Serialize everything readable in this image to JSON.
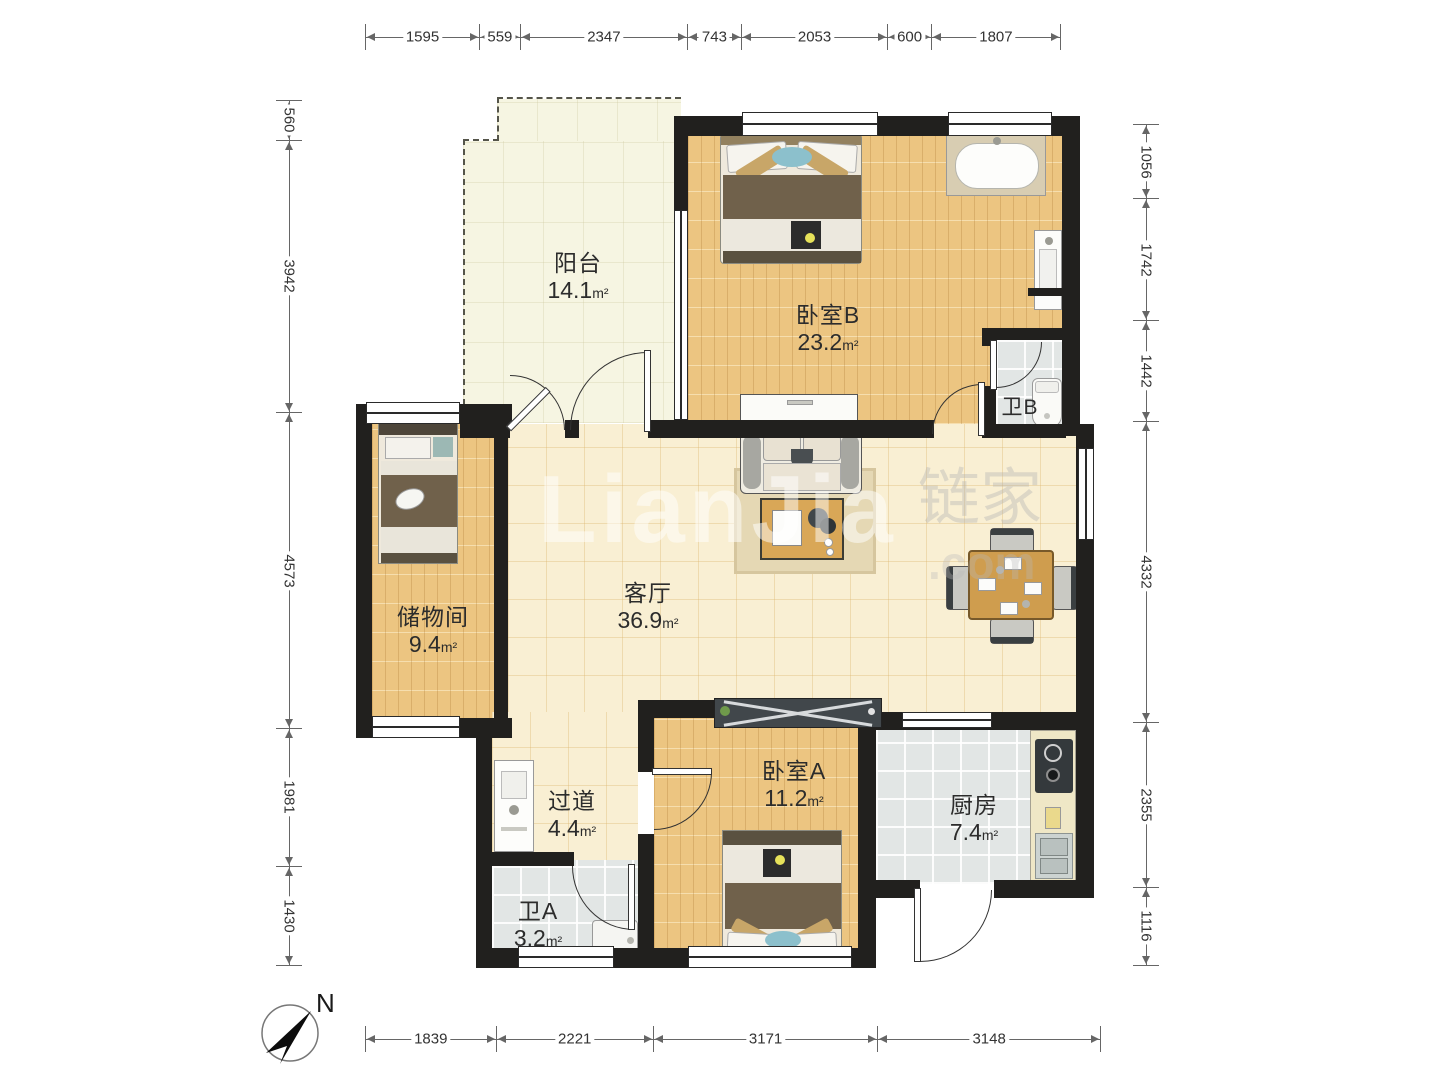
{
  "dimensions": {
    "top": [
      "1595",
      "559",
      "2347",
      "743",
      "2053",
      "600",
      "1807"
    ],
    "bottom": [
      "1839",
      "2221",
      "3171",
      "3148"
    ],
    "left": [
      "560",
      "3942",
      "4573",
      "1981",
      "1430"
    ],
    "right": [
      "1056",
      "1742",
      "1442",
      "4332",
      "2355",
      "1116"
    ]
  },
  "rooms": [
    {
      "key": "balcony",
      "name": "阳台",
      "area": "14.1",
      "unit": "m²"
    },
    {
      "key": "bedroom-b",
      "name": "卧室B",
      "area": "23.2",
      "unit": "m²"
    },
    {
      "key": "bath-b",
      "name": "卫B",
      "area": "",
      "unit": ""
    },
    {
      "key": "storage",
      "name": "储物间",
      "area": "9.4",
      "unit": "m²"
    },
    {
      "key": "living-room",
      "name": "客厅",
      "area": "36.9",
      "unit": "m²"
    },
    {
      "key": "hallway",
      "name": "过道",
      "area": "4.4",
      "unit": "m²"
    },
    {
      "key": "bedroom-a",
      "name": "卧室A",
      "area": "11.2",
      "unit": "m²"
    },
    {
      "key": "kitchen",
      "name": "厨房",
      "area": "7.4",
      "unit": "m²"
    },
    {
      "key": "bath-a",
      "name": "卫A",
      "area": "3.2",
      "unit": "m²"
    }
  ],
  "compass": {
    "label": "N"
  },
  "watermark": {
    "latin": "LianJia",
    "cn": "链家",
    "suffix": ".com"
  },
  "colors": {
    "wall": "#21201e",
    "wood_floor": "#ecc581",
    "warm_tile": "#f9efd3",
    "gray_tile": "#e2e6e5",
    "balcony_floor": "#f6f5e2",
    "dimension_text": "#333333"
  }
}
